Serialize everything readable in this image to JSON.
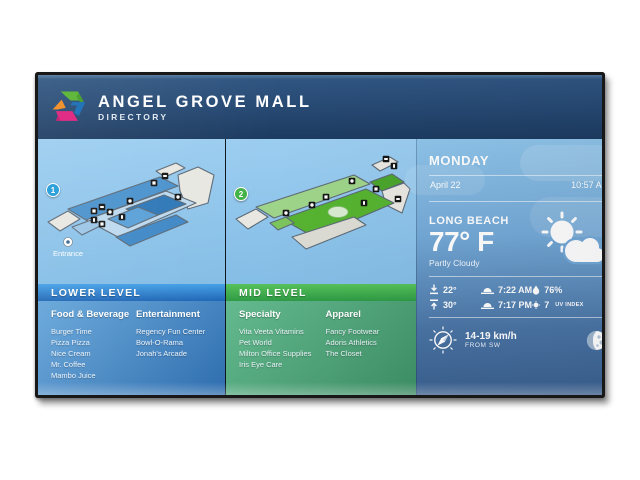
{
  "header": {
    "title": "ANGEL GROVE MALL",
    "subtitle": "DIRECTORY"
  },
  "lower": {
    "badge": "1",
    "bar": "LOWER LEVEL",
    "entrance": "Entrance",
    "col1": {
      "title": "Food & Beverage",
      "items": [
        "Burger Time",
        "Pizza Pizza",
        "Nice Cream",
        "Mr. Coffee",
        "Mambo Juice"
      ]
    },
    "col2": {
      "title": "Entertainment",
      "items": [
        "Regency Fun Center",
        "Bowl-O-Rama",
        "Jonah's Arcade"
      ]
    }
  },
  "mid": {
    "badge": "2",
    "bar": "MID LEVEL",
    "col1": {
      "title": "Specialty",
      "items": [
        "Vita Veeta Vitamins",
        "Pet World",
        "Milton Office Supplies",
        "Iris Eye Care"
      ]
    },
    "col2": {
      "title": "Apparel",
      "items": [
        "Fancy Footwear",
        "Adoris Athletics",
        "The Closet"
      ]
    }
  },
  "weather": {
    "day": "MONDAY",
    "date": "April 22",
    "time": "10:57 AM",
    "city": "LONG BEACH",
    "temp": "77° F",
    "condition": "Partly Cloudy",
    "low": "22°",
    "high": "30°",
    "sunrise": "7:22 AM",
    "sunset": "7:17 PM",
    "humidity": "76%",
    "uv_value": "7",
    "uv_label": "UV INDEX",
    "wind_speed": "14-19 km/h",
    "wind_direction": "FROM SW"
  },
  "colors": {
    "header_navy": "#24466e",
    "lower_bar_blue": "#2b7fd0",
    "mid_bar_green": "#3fae4d",
    "panel_steel_blue": "#3a6190",
    "sky_blue": "#8fc4e9",
    "logo_green": "#55b42e",
    "logo_blue": "#156bb4",
    "logo_orange": "#f18b20",
    "logo_pink": "#df1e7c"
  }
}
